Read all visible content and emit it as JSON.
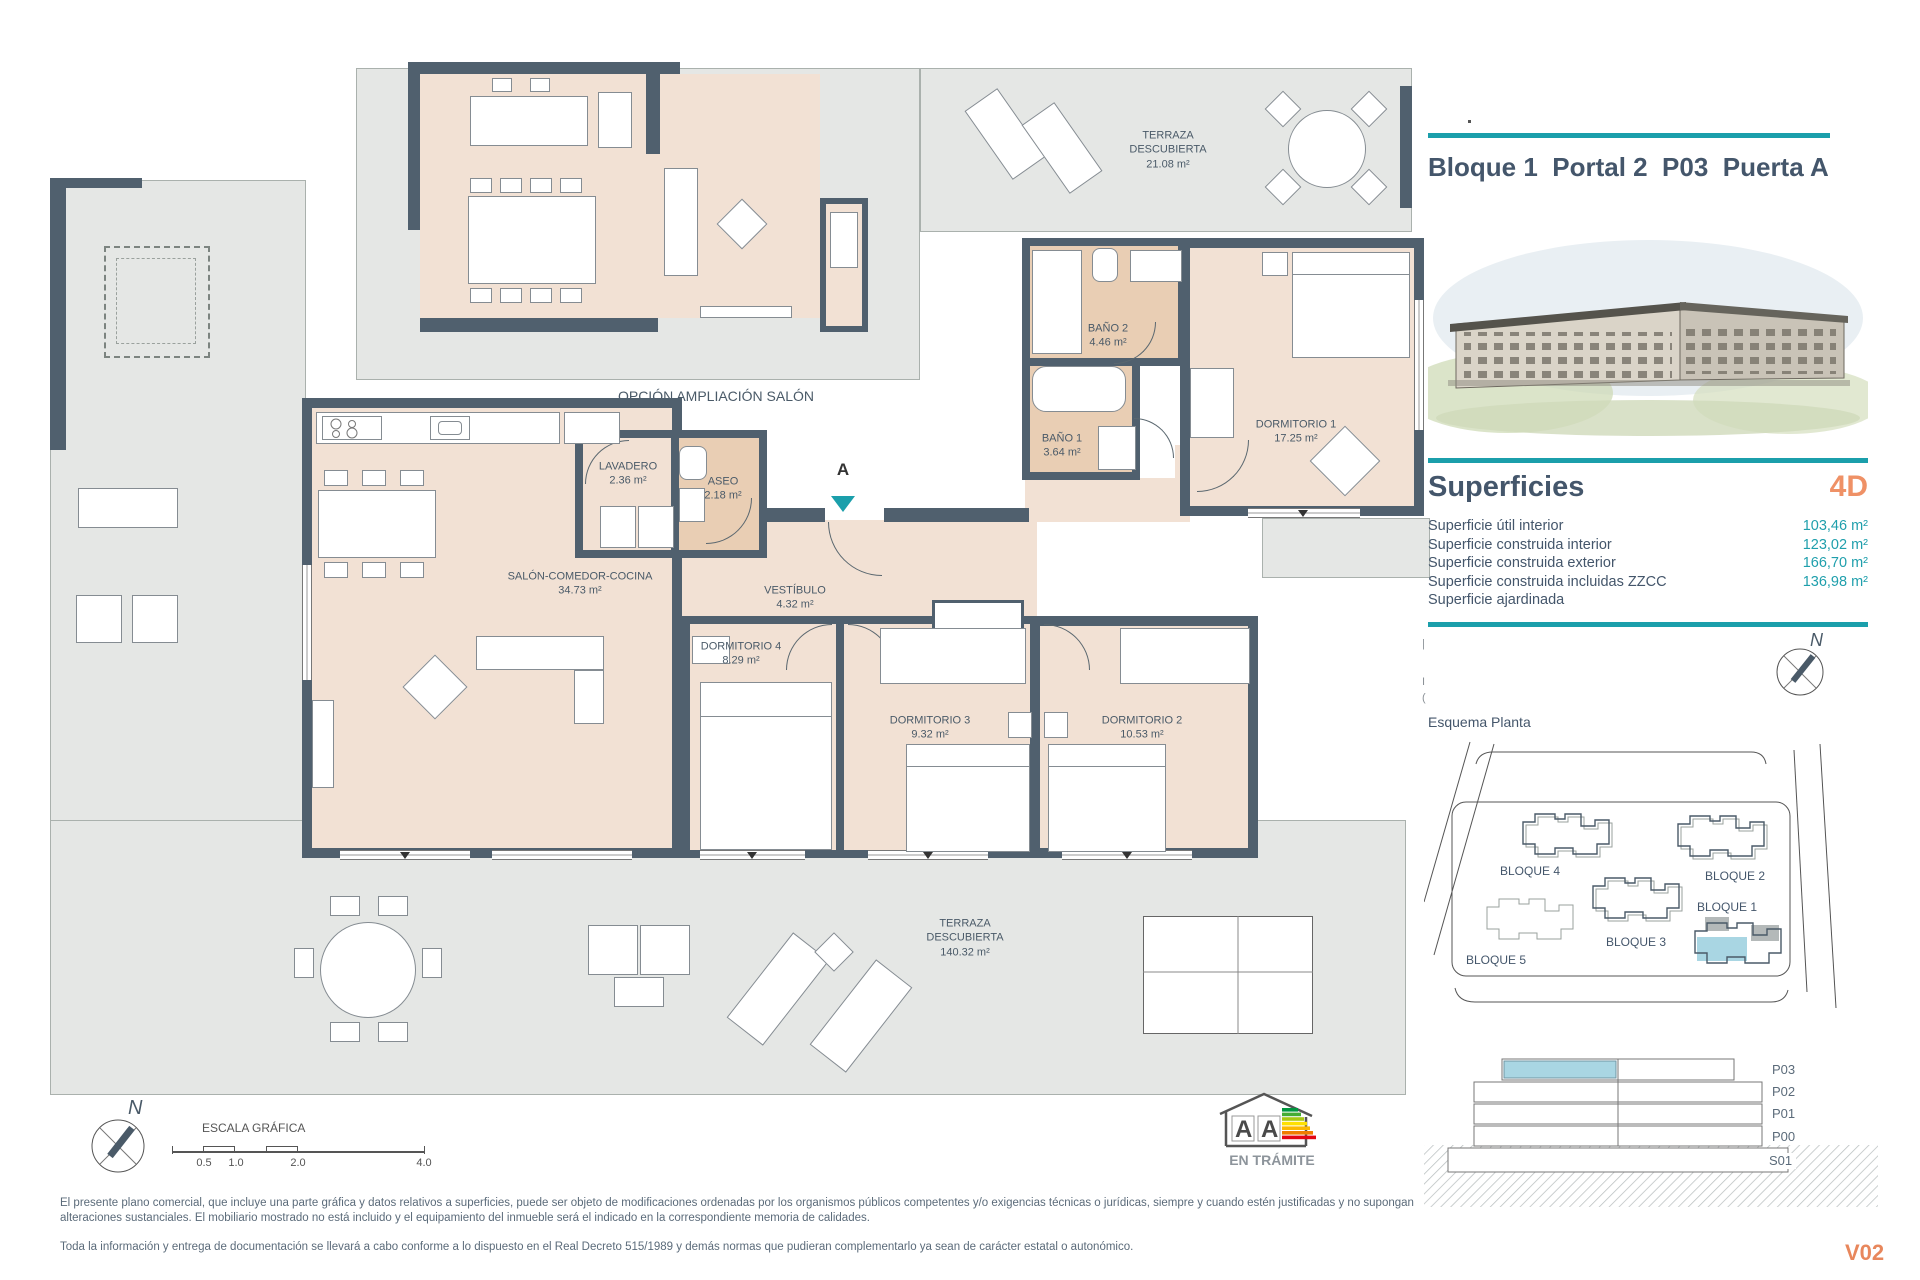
{
  "meta": {
    "version": "V02"
  },
  "header": {
    "title": "Bloque 1  Portal 2  P03  Puerta A"
  },
  "superficies": {
    "heading": "Superficies",
    "type_label": "4D",
    "rows": [
      {
        "label": "Superficie útil interior",
        "value": "103,46 m²"
      },
      {
        "label": "Superficie construida interior",
        "value": "123,02 m²"
      },
      {
        "label": "Superficie construida exterior",
        "value": "166,70 m²"
      },
      {
        "label": "Superficie construida incluidas ZZCC",
        "value": "136,98 m²"
      },
      {
        "label": "Superficie ajardinada",
        "value": ""
      }
    ]
  },
  "esquema": {
    "label": "Esquema Planta",
    "blocks": [
      "BLOQUE 4",
      "BLOQUE 2",
      "BLOQUE 5",
      "BLOQUE 3",
      "BLOQUE 1"
    ]
  },
  "compass": {
    "north": "N"
  },
  "section": {
    "levels": [
      "P03",
      "P02",
      "P01",
      "P00",
      "S01"
    ]
  },
  "plan": {
    "annex_label": "OPCIÓN AMPLIACIÓN SALÓN",
    "section_marker": "A",
    "rooms": [
      {
        "name": "TERRAZA DESCUBIERTA",
        "area": "21.08 m²"
      },
      {
        "name": "SALÓN-COMEDOR-COCINA",
        "area": "34.73 m²"
      },
      {
        "name": "LAVADERO",
        "area": "2.36 m²"
      },
      {
        "name": "ASEO",
        "area": "2.18 m²"
      },
      {
        "name": "VESTÍBULO",
        "area": "4.32 m²"
      },
      {
        "name": "DORMITORIO 4",
        "area": "8.29 m²"
      },
      {
        "name": "DORMITORIO 3",
        "area": "9.32 m²"
      },
      {
        "name": "DORMITORIO 2",
        "area": "10.53 m²"
      },
      {
        "name": "DORMITORIO 1",
        "area": "17.25 m²"
      },
      {
        "name": "BAÑO 1",
        "area": "3.64 m²"
      },
      {
        "name": "BAÑO 2",
        "area": "4.46 m²"
      },
      {
        "name": "TERRAZA DESCUBIERTA",
        "area": "140.32 m²"
      }
    ]
  },
  "scale": {
    "label": "ESCALA GRÁFICA",
    "ticks": [
      "0.5",
      "1.0",
      "2.0",
      "4.0"
    ]
  },
  "energy": {
    "status": "EN TRÁMITE",
    "letters": [
      "A",
      "A"
    ]
  },
  "footer": {
    "disclaimer1": "El presente plano comercial, que incluye una parte gráfica y datos relativos a superficies, puede ser objeto de modificaciones ordenadas por los organismos públicos competentes y/o exigencias técnicas o jurídicas, siempre y cuando estén justificadas y no supongan alteraciones sustanciales. El mobiliario mostrado no está incluido y el equipamiento del inmueble será el indicado en la correspondiente memoria de calidades.",
    "disclaimer2": "Toda la información y entrega de documentación se llevará a cabo conforme a lo dispuesto en el Real Decreto 515/1989 y demás normas que pudieran complementarlo ya sean de carácter estatal o autonómico."
  },
  "colors": {
    "accent_teal": "#1b9fab",
    "accent_orange": "#ef9166",
    "wall": "#50606e",
    "floor": "#f2e1d4",
    "bath_floor": "#e9ceb4",
    "terrace": "#e5e7e5",
    "highlight_blue": "#a9d6e3",
    "text_dark": "#44566b"
  }
}
